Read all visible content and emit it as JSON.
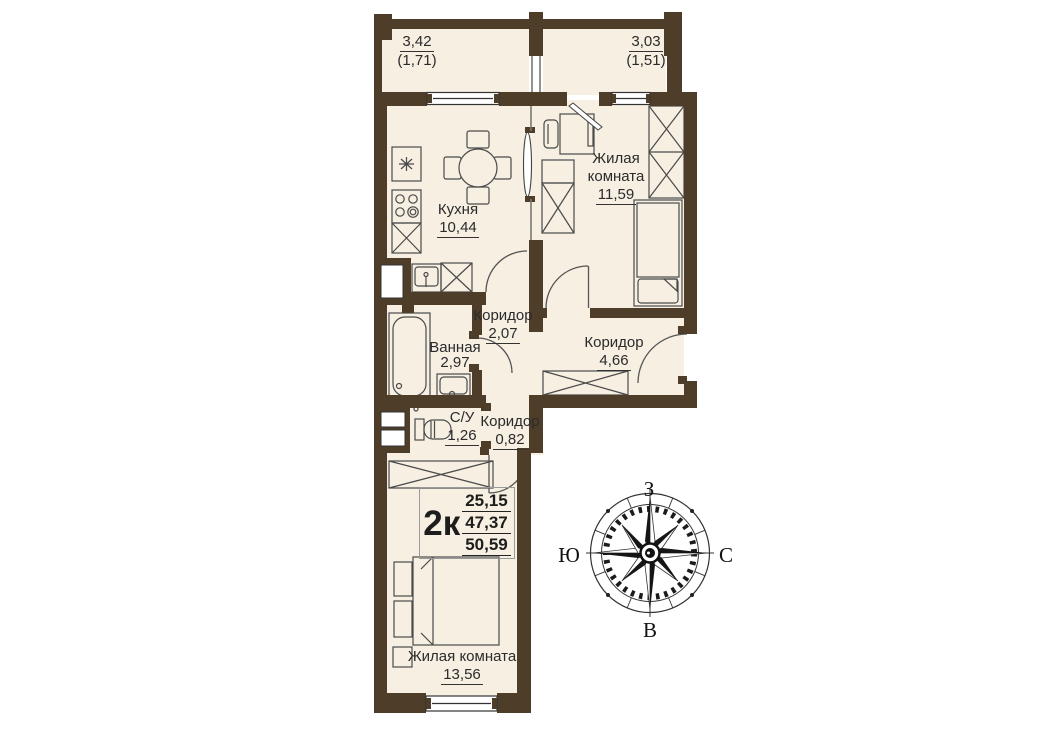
{
  "plan": {
    "type_label": "2к",
    "areas": {
      "living": "25,15",
      "apartment": "47,37",
      "total": "50,59"
    },
    "rooms": [
      {
        "id": "balcony-left",
        "name": "",
        "area": "3,42",
        "area_coef": "(1,71)"
      },
      {
        "id": "balcony-right",
        "name": "",
        "area": "3,03",
        "area_coef": "(1,51)"
      },
      {
        "id": "kitchen",
        "name": "Кухня",
        "area": "10,44"
      },
      {
        "id": "living-room-1",
        "name": "Жилая комната",
        "area": "11,59"
      },
      {
        "id": "corridor-1",
        "name": "Коридор",
        "area": "2,07"
      },
      {
        "id": "bathroom",
        "name": "Ванная",
        "area": "2,97"
      },
      {
        "id": "corridor-2",
        "name": "Коридор",
        "area": "4,66"
      },
      {
        "id": "wc",
        "name": "С/У",
        "area": "1,26"
      },
      {
        "id": "corridor-3",
        "name": "Коридор",
        "area": "0,82"
      },
      {
        "id": "living-room-2",
        "name": "Жилая комната",
        "area": "13,56"
      }
    ],
    "compass": {
      "top": "З",
      "left": "Ю",
      "right": "С",
      "bottom": "В"
    },
    "colors": {
      "wall": "#4e3d28",
      "floor": "#f6efe2",
      "outline": "#4a4a4a",
      "text": "#2b2b2b"
    }
  }
}
